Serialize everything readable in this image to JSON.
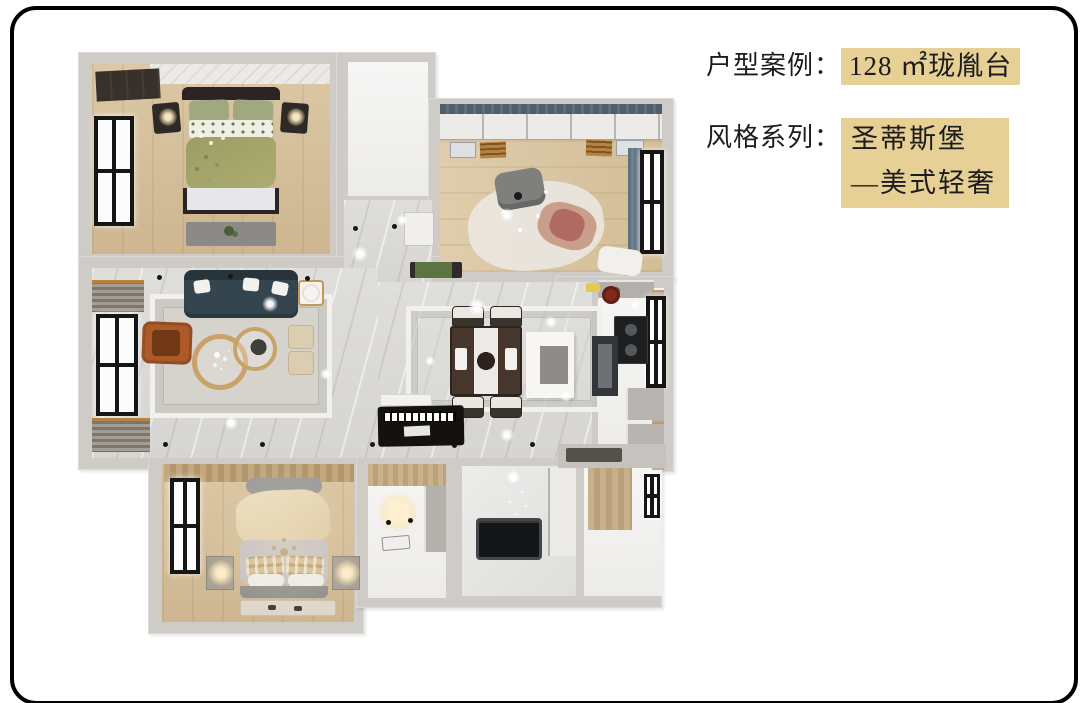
{
  "info": {
    "line1_label": "户型案例：",
    "line1_value": "128 ㎡珑胤台",
    "line2_label": "风格系列：",
    "line2_value_line1": "圣蒂斯堡",
    "line2_value_line2": "—美式轻奢"
  },
  "palette": {
    "highlight": "#e6d095",
    "text": "#1c1c1c",
    "frame": "#000000",
    "wall": "#cfccc7",
    "wood": "#d6c2a0",
    "marble": "#dbdad7",
    "window": "#161616"
  },
  "floorplan": {
    "type": "3d-top-down-render",
    "rooms": [
      "bedroom-top-left",
      "wardrobe-closet-top",
      "bedroom-top-right",
      "entry-foyer",
      "living-room",
      "dining-room",
      "kitchen",
      "master-bedroom",
      "walk-in-closet",
      "bathroom",
      "balcony"
    ]
  }
}
